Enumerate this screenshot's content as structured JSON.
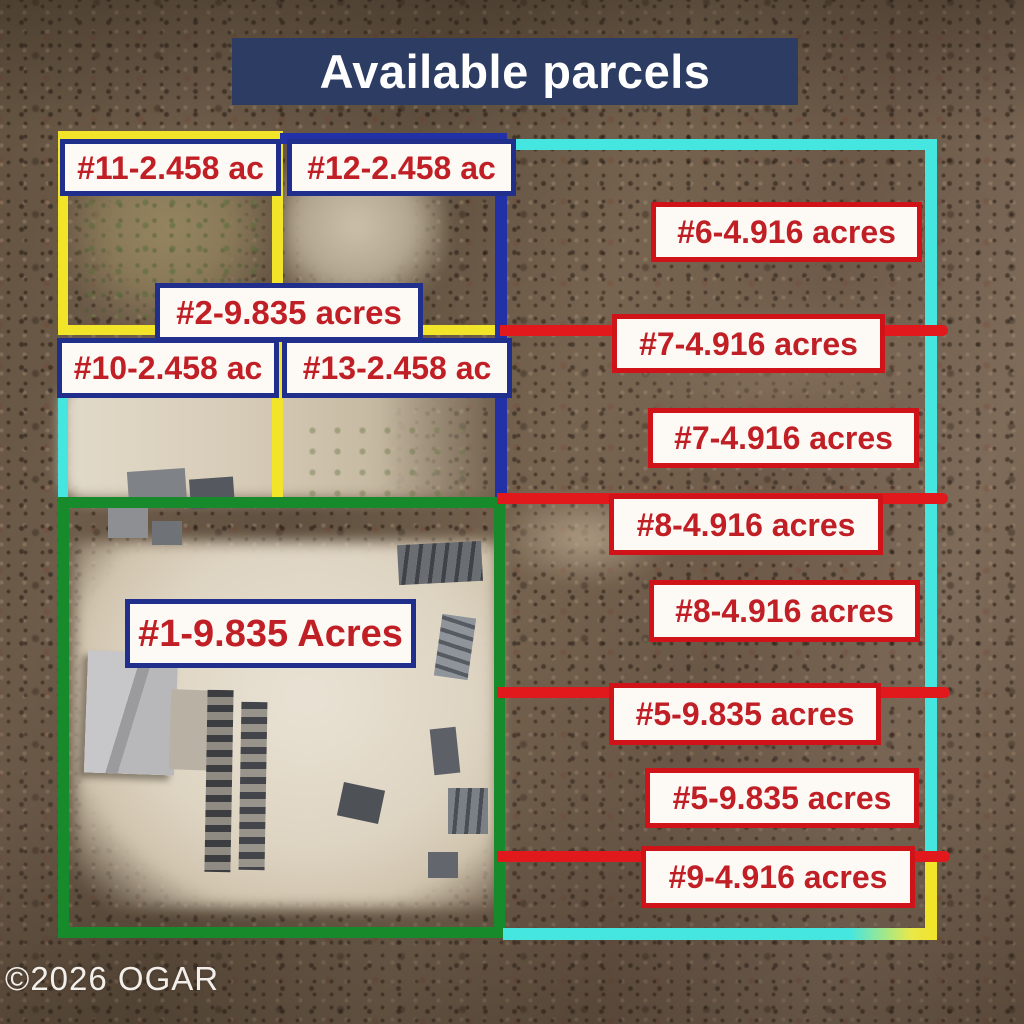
{
  "title": "Available parcels",
  "watermark": "©2026 OGAR",
  "labels": {
    "p11": {
      "text": "#11-2.458 ac",
      "border": "navy"
    },
    "p12": {
      "text": "#12-2.458 ac",
      "border": "navy"
    },
    "p6": {
      "text": "#6-4.916 acres",
      "border": "red"
    },
    "p2": {
      "text": "#2-9.835 acres",
      "border": "navy"
    },
    "p7a": {
      "text": "#7-4.916 acres",
      "border": "red"
    },
    "p10": {
      "text": "#10-2.458 ac",
      "border": "navy"
    },
    "p13": {
      "text": "#13-2.458 ac",
      "border": "navy"
    },
    "p7b": {
      "text": "#7-4.916 acres",
      "border": "red"
    },
    "p8a": {
      "text": "#8-4.916 acres",
      "border": "red"
    },
    "p8b": {
      "text": "#8-4.916 acres",
      "border": "red"
    },
    "p1": {
      "text": "#1-9.835 Acres",
      "border": "navy"
    },
    "p5a": {
      "text": "#5-9.835 acres",
      "border": "red"
    },
    "p5b": {
      "text": "#5-9.835 acres",
      "border": "red"
    },
    "p9": {
      "text": "#9-4.916 acres",
      "border": "red"
    }
  },
  "colors": {
    "title_bg": "#2d3c62",
    "title_text": "#ffffff",
    "label_bg": "#fdfaf5",
    "label_text": "#c01f26",
    "label_border_navy": "#212f8c",
    "label_border_red": "#cf1318",
    "divider_line_red": "#e2191c",
    "boundary_yellow": "#f2e428",
    "boundary_cyan": "#46e6e0",
    "boundary_green": "#178a2b",
    "boundary_blue": "#2231a5",
    "watermark_text": "#f2efeb"
  }
}
